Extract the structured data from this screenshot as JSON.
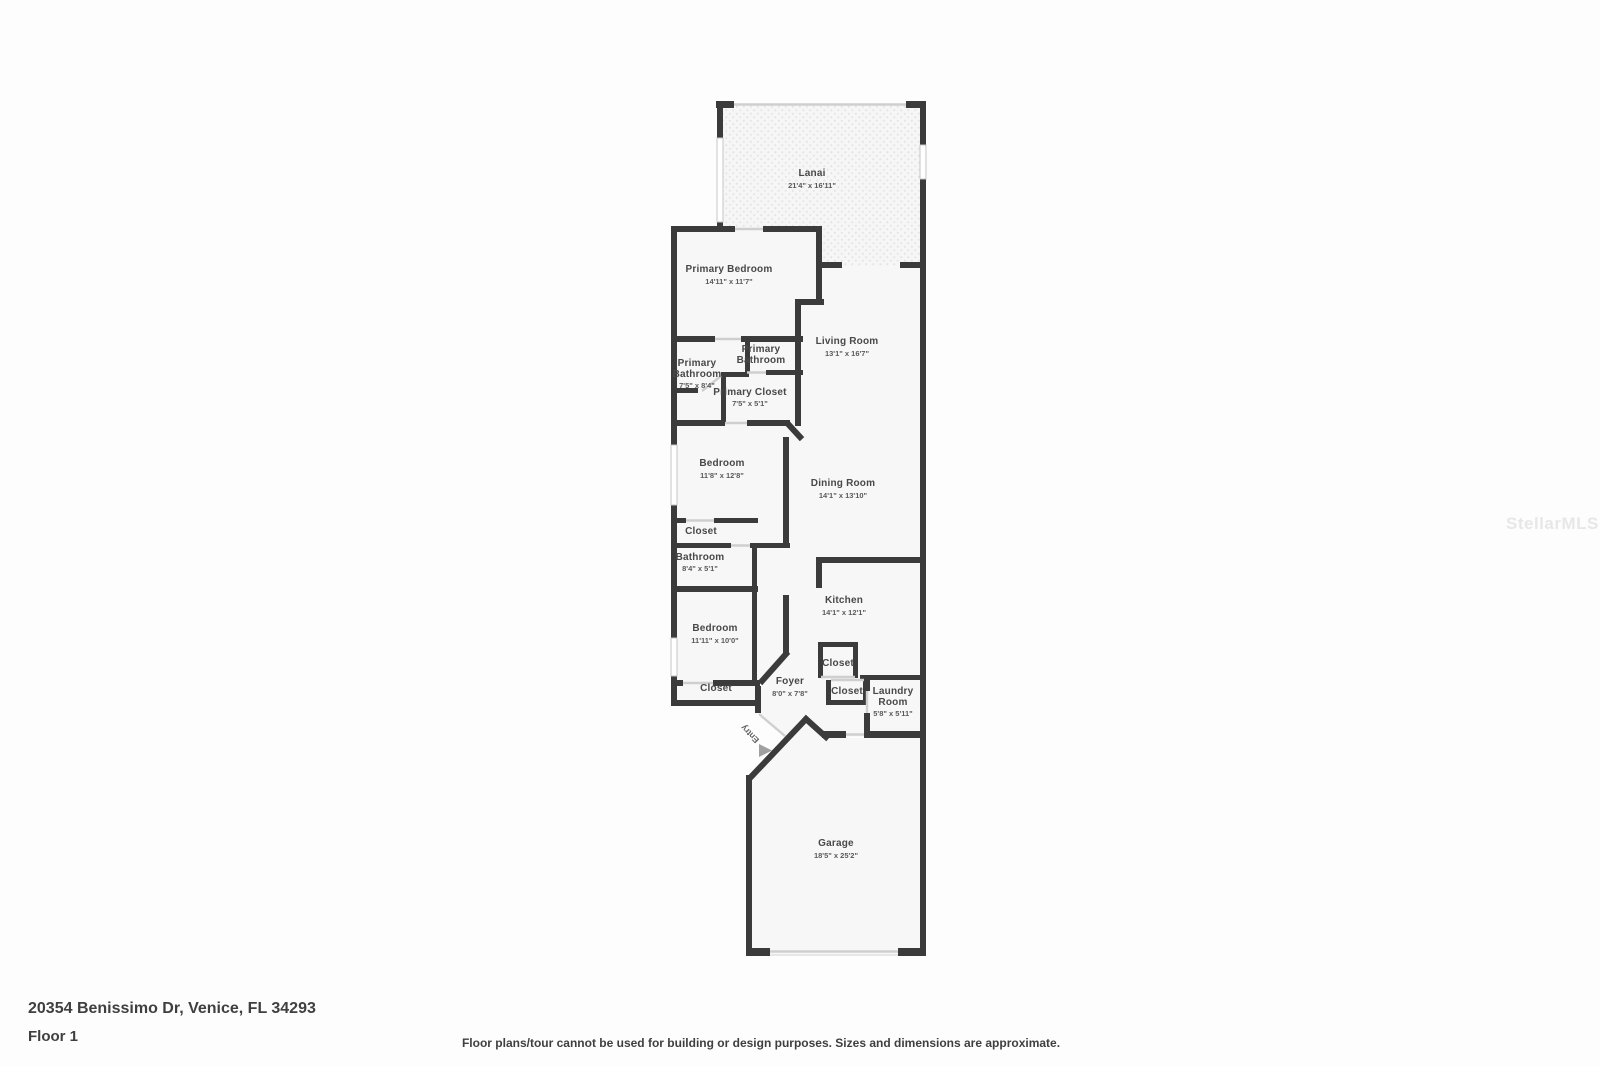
{
  "plan": {
    "rooms": {
      "lanai": {
        "name": "Lanai",
        "dims": "21'4\" x 16'11\""
      },
      "primary_bedroom": {
        "name": "Primary Bedroom",
        "dims": "14'11\" x 11'7\""
      },
      "primary_bathroom_small": {
        "line1": "Primary",
        "line2": "Bathroom"
      },
      "primary_bathroom": {
        "line1": "Primary",
        "line2": "Bathroom",
        "dims": "7'5\" x 8'4\""
      },
      "primary_closet": {
        "name": "Primary Closet",
        "dims": "7'5\" x 5'1\""
      },
      "living_room": {
        "name": "Living Room",
        "dims": "13'1\" x 16'7\""
      },
      "bedroom_upper": {
        "name": "Bedroom",
        "dims": "11'8\" x 12'8\""
      },
      "dining_room": {
        "name": "Dining Room",
        "dims": "14'1\" x 13'10\""
      },
      "closet_upper": {
        "name": "Closet"
      },
      "bathroom": {
        "name": "Bathroom",
        "dims": "8'4\" x 5'1\""
      },
      "bedroom_lower": {
        "name": "Bedroom",
        "dims": "11'11\" x 10'0\""
      },
      "kitchen": {
        "name": "Kitchen",
        "dims": "14'1\" x 12'1\""
      },
      "closet_kitchen": {
        "name": "Closet"
      },
      "closet_foyer": {
        "name": "Closet"
      },
      "foyer": {
        "name": "Foyer",
        "dims": "8'0\" x 7'8\""
      },
      "laundry_room": {
        "line1": "Laundry",
        "line2": "Room",
        "dims": "5'8\" x 5'11\""
      },
      "closet_bedroom": {
        "name": "Closet"
      },
      "garage": {
        "name": "Garage",
        "dims": "18'5\" x 25'2\""
      },
      "entry": {
        "label": "Entry"
      }
    },
    "colors": {
      "wall": "#3b3b3b",
      "floor": "#f7f7f7",
      "lanai_dots": "#e3e3e3",
      "opening": "#cfcfcf",
      "label_text": "#484848",
      "dims_text": "#5a5a5a",
      "entry_arrow": "#a0a0a0"
    }
  },
  "watermark": {
    "text": "StellarMLS"
  },
  "footer": {
    "address": "20354 Benissimo Dr, Venice, FL 34293",
    "floor_label": "Floor 1",
    "disclaimer": "Floor plans/tour cannot be used for building or design purposes. Sizes and dimensions are approximate."
  }
}
